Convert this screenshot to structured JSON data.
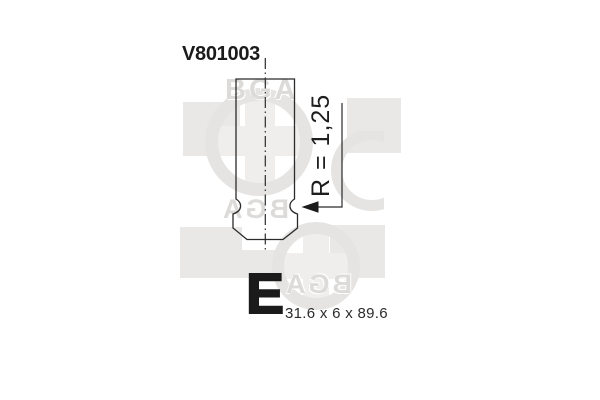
{
  "part_number": "V801003",
  "annotations": {
    "radius": "R = 1,25",
    "valve_marker": "E",
    "dimensions": "31.6 x 6 x 89.6"
  },
  "watermark": {
    "brand_text": "BGA"
  },
  "colors": {
    "background": "#ffffff",
    "line": "#2b2b2b",
    "text": "#1b1b1b",
    "watermark_square": "#e9e8e6",
    "watermark_ring": "#e5e4e2",
    "watermark_cross": "#efeeec",
    "watermark_text": "#dcdbd9"
  }
}
